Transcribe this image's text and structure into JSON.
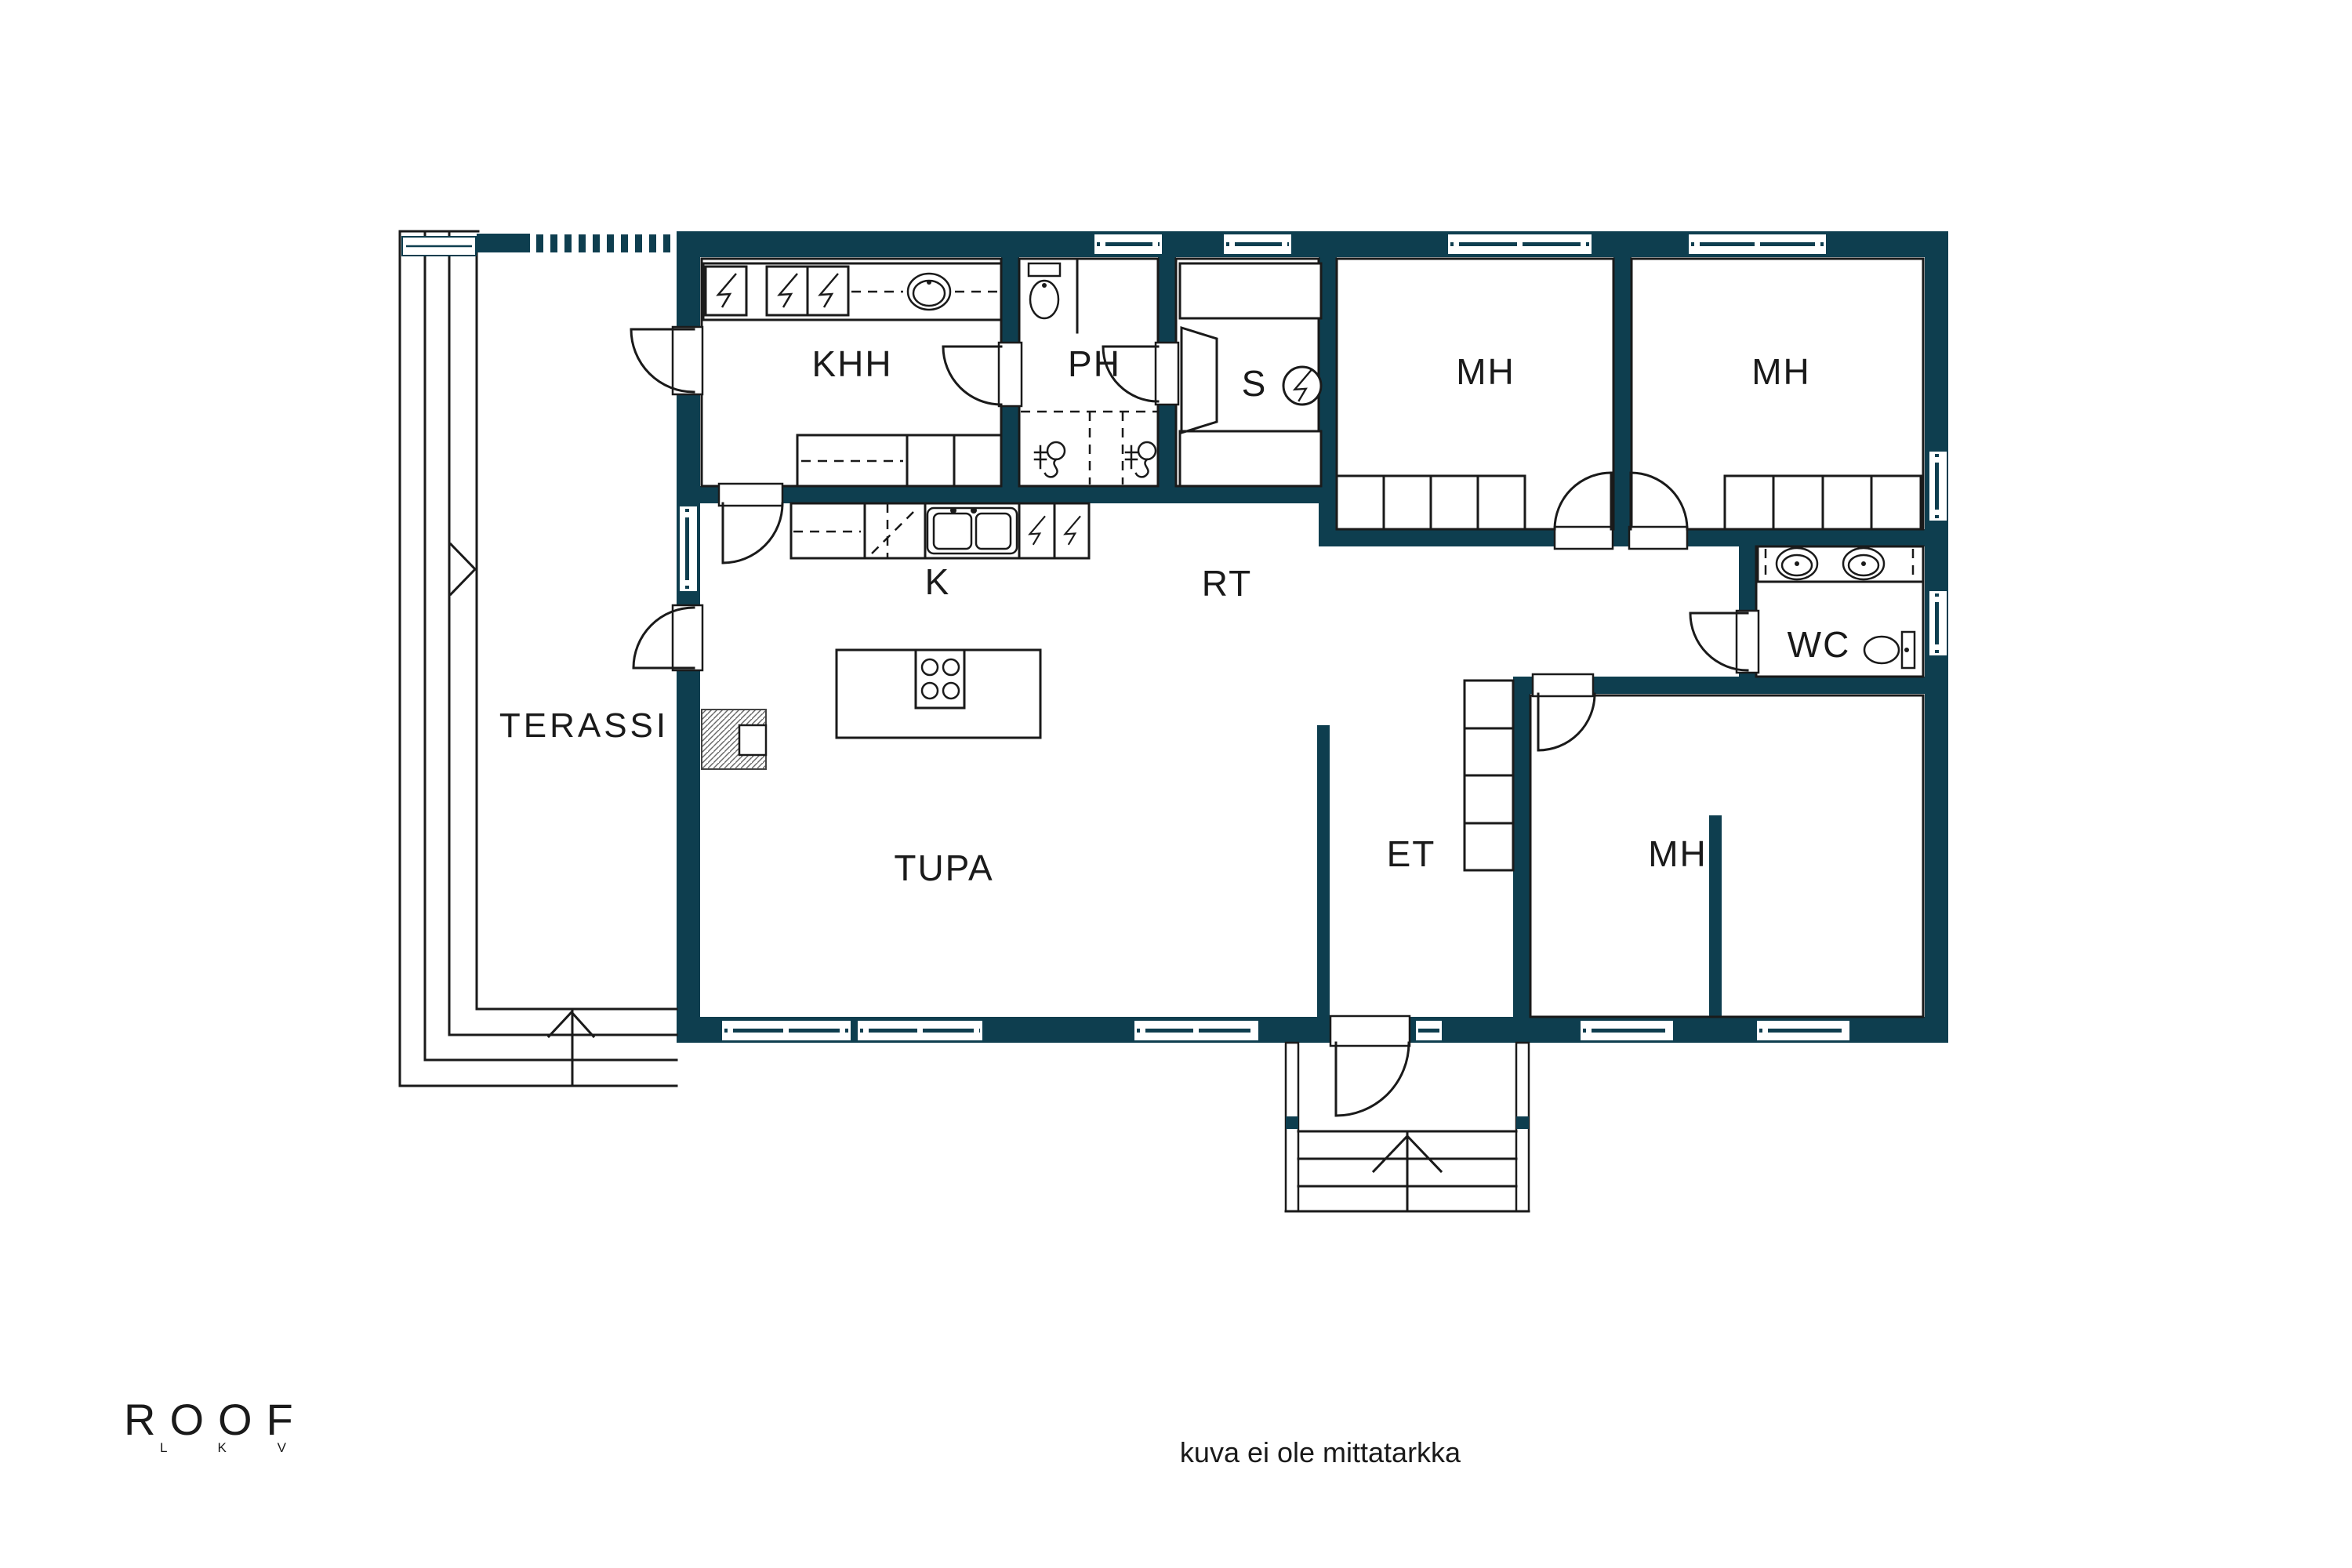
{
  "colors": {
    "wall": "#0e3e4f",
    "line": "#1a1a1a",
    "background": "#ffffff"
  },
  "rooms": [
    {
      "id": "khh",
      "label": "KHH"
    },
    {
      "id": "ph",
      "label": "PH"
    },
    {
      "id": "sauna",
      "label": "S"
    },
    {
      "id": "mh-top-left",
      "label": "MH"
    },
    {
      "id": "mh-top-right",
      "label": "MH"
    },
    {
      "id": "kitchen",
      "label": "K"
    },
    {
      "id": "rt-hall",
      "label": "RT"
    },
    {
      "id": "wc",
      "label": "WC"
    },
    {
      "id": "terassi",
      "label": "TERASSI"
    },
    {
      "id": "tupa",
      "label": "TUPA"
    },
    {
      "id": "et",
      "label": "ET"
    },
    {
      "id": "mh-bottom",
      "label": "MH"
    }
  ],
  "fixtures": [
    "washing-machine-icon",
    "laundry-sink-icon",
    "toilet-icon",
    "shower-icon",
    "sauna-bench-icon",
    "sauna-stove-icon",
    "kitchen-sink-icon",
    "dishwasher-icon",
    "island-hob-icon",
    "fireplace-icon",
    "wardrobe-icon",
    "hall-closet-icon",
    "wc-sink-icon",
    "entrance-steps-icon",
    "terrace-steps-icon",
    "direction-arrow-icon"
  ],
  "logo": {
    "name": "ROOF",
    "letters": "L K V"
  },
  "footer": {
    "disclaimer": "kuva ei ole mittatarkka"
  }
}
